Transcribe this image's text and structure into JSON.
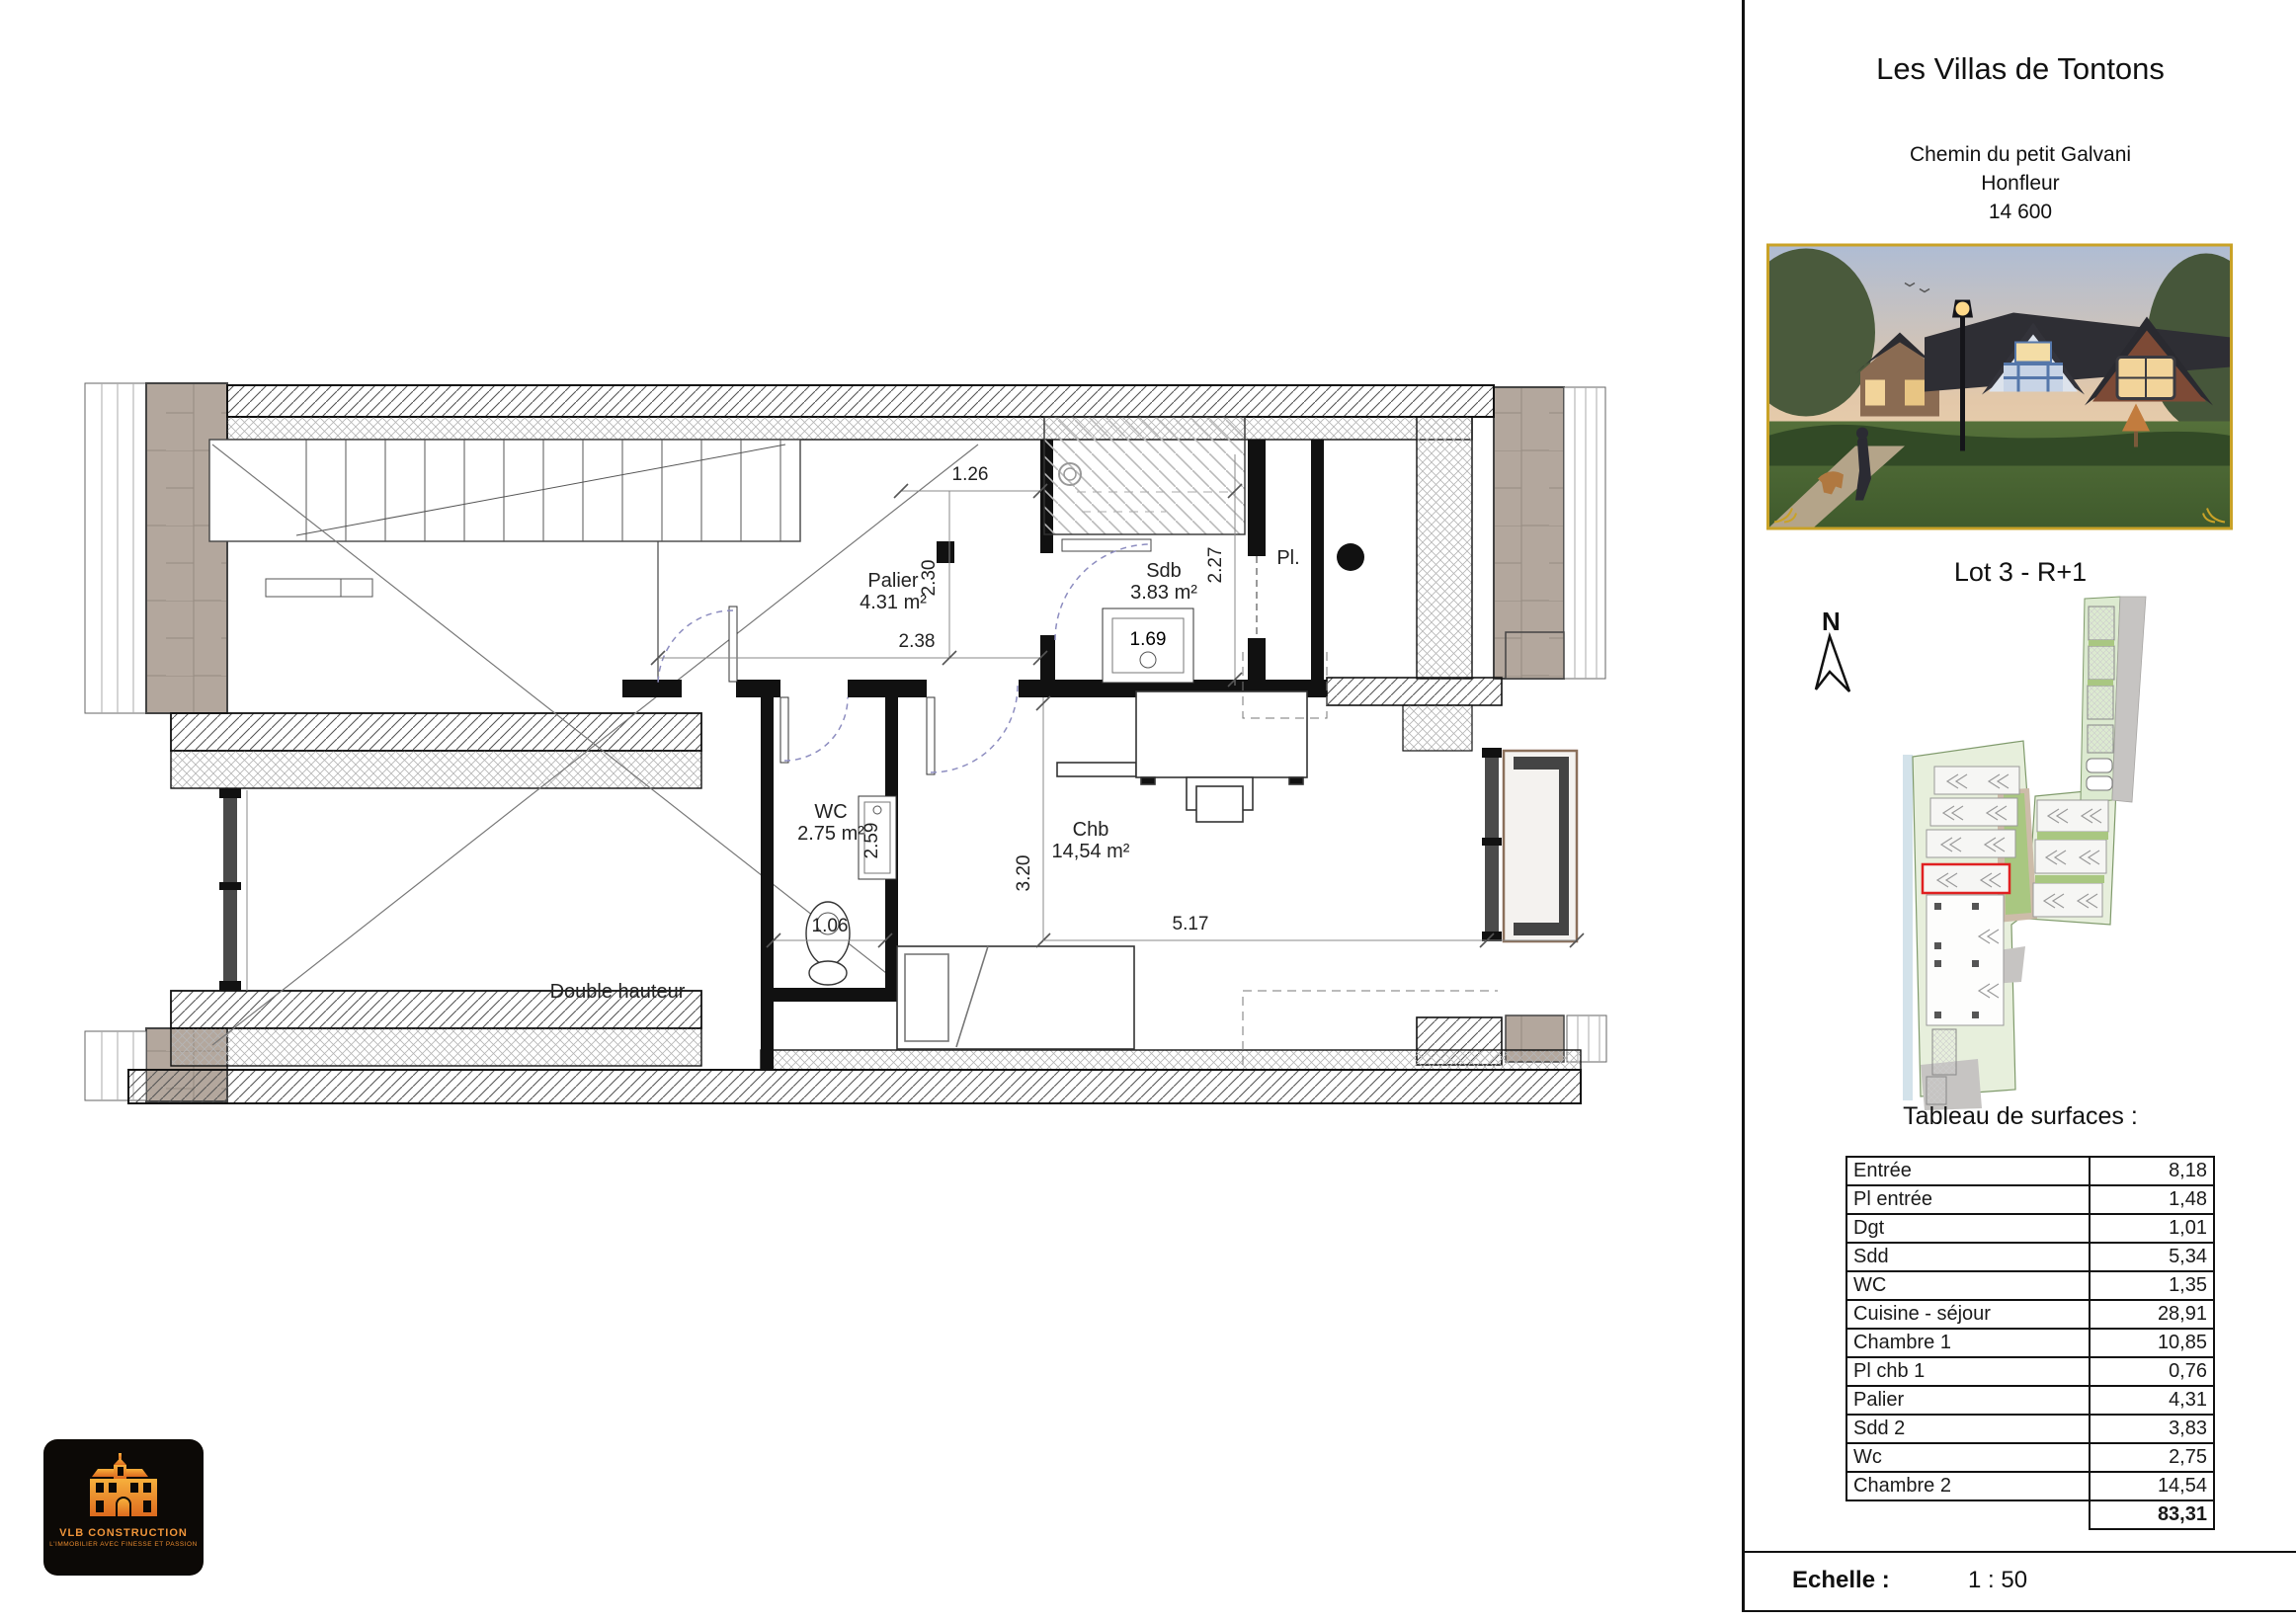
{
  "header": {
    "title": "Les Villas de Tontons",
    "address": [
      "Chemin du petit Galvani",
      "Honfleur",
      "14 600"
    ]
  },
  "lot": {
    "label": "Lot 3 - R+1"
  },
  "compass": {
    "label": "N"
  },
  "surface_table": {
    "title": "Tableau de surfaces :",
    "rows": [
      {
        "label": "Entrée",
        "value": "8,18"
      },
      {
        "label": "Pl entrée",
        "value": "1,48"
      },
      {
        "label": "Dgt",
        "value": "1,01"
      },
      {
        "label": "Sdd",
        "value": "5,34"
      },
      {
        "label": "WC",
        "value": "1,35"
      },
      {
        "label": "Cuisine - séjour",
        "value": "28,91"
      },
      {
        "label": "Chambre 1",
        "value": "10,85"
      },
      {
        "label": "Pl chb 1",
        "value": "0,76"
      },
      {
        "label": "Palier",
        "value": "4,31"
      },
      {
        "label": "Sdd 2",
        "value": "3,83"
      },
      {
        "label": "Wc",
        "value": "2,75"
      },
      {
        "label": "Chambre 2",
        "value": "14,54"
      }
    ],
    "total_value": "83,31"
  },
  "scale_bar": {
    "label": "Echelle :",
    "value": "1 : 50"
  },
  "logo": {
    "company": "VLB CONSTRUCTION",
    "tagline": "L'IMMOBILIER AVEC FINESSE ET PASSION"
  },
  "floor_plan": {
    "rooms": {
      "palier": {
        "name": "Palier",
        "area": "4.31 m²"
      },
      "sdb": {
        "name": "Sdb",
        "area": "3.83 m²"
      },
      "placard": {
        "name": "Pl."
      },
      "wc": {
        "name": "WC",
        "area": "2.75 m²"
      },
      "chambre": {
        "name": "Chb",
        "area": "14,54 m²"
      },
      "double_height": "Double hauteur"
    },
    "dims": {
      "top": "1.26",
      "palier_h": "2.30",
      "sdb_h": "2.27",
      "palier_w": "2.38",
      "basin": "1.69",
      "wc_h": "2.59",
      "wc_w": "1.06",
      "chb_h": "3.20",
      "chb_w": "5.17"
    }
  },
  "colors": {
    "highlight_red": "#e02020",
    "frame_gold": "#c9a227",
    "facade_taupe": "#b3a79d"
  }
}
